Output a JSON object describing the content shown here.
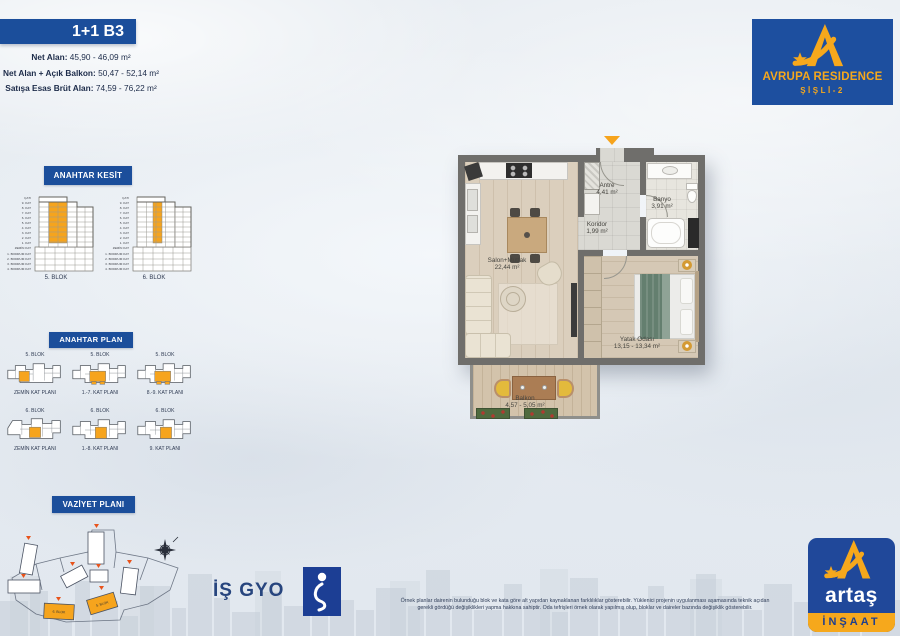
{
  "unit": {
    "title": "1+1 B3",
    "areas": [
      {
        "label": "Net Alan:",
        "value": "45,90 - 46,09 m²"
      },
      {
        "label": "Net Alan + Açık Balkon:",
        "value": "50,47 - 52,14 m²"
      },
      {
        "label": "Satışa Esas Brüt Alan:",
        "value": "74,59 - 76,22 m²"
      }
    ]
  },
  "kesit": {
    "title": "ANAHTAR KESİT",
    "floors": [
      "ÇATI",
      "9. KAT",
      "8. KAT",
      "7. KAT",
      "6. KAT",
      "5. KAT",
      "4. KAT",
      "3. KAT",
      "2. KAT",
      "1. KAT",
      "ZEMİN KAT",
      "1. BODRUM KAT",
      "2. BODRUM KAT",
      "3. BODRUM KAT",
      "4. BODRUM KAT"
    ],
    "blocks": [
      "5. BLOK",
      "6. BLOK"
    ]
  },
  "plan": {
    "title": "ANAHTAR PLAN",
    "items": [
      {
        "block": "5. BLOK",
        "floor": "ZEMİN KAT PLANI"
      },
      {
        "block": "5. BLOK",
        "floor": "1.-7. KAT PLANI"
      },
      {
        "block": "5. BLOK",
        "floor": "8.-9. KAT PLANI"
      },
      {
        "block": "6. BLOK",
        "floor": "ZEMİN KAT PLANI"
      },
      {
        "block": "6. BLOK",
        "floor": "1.-8. KAT PLANI"
      },
      {
        "block": "6. BLOK",
        "floor": "9. KAT PLANI"
      }
    ]
  },
  "vaziyet": {
    "title": "VAZİYET PLANI",
    "labels": [
      "6. BLOK",
      "5. BLOK"
    ]
  },
  "rooms": [
    {
      "name": "Antre",
      "area": "4,41 m²"
    },
    {
      "name": "Banyo",
      "area": "3,91 m²"
    },
    {
      "name": "Koridor",
      "area": "1,99 m²"
    },
    {
      "name": "Salon+Mutfak",
      "area": "22,44 m²"
    },
    {
      "name": "Yatak Odası",
      "area": "13,15 - 13,34 m²"
    },
    {
      "name": "Balkon",
      "area": "4,57 - 5,05 m²"
    }
  ],
  "brand": {
    "avrupa": {
      "name": "AVRUPA RESIDENCE",
      "sub": "ŞİŞLİ-2"
    },
    "isgyo": "İŞ GYO",
    "artas": {
      "name": "artaş",
      "sub": "İNŞAAT"
    }
  },
  "footer": {
    "line1": "Örnek planlar dairenin bulunduğu blok ve kata göre alt yapıdan kaynaklanan farklılıklar gösterebilir. Yüklenici projenin uygulanması aşamasında teknik açıdan",
    "line2": "gerekli gördüğü değişiklikleri yapma hakkına sahiptir. Oda tefrişleri örnek olarak yapılmış olup, bloklar ve daireler bazında değişiklik gösterebilir."
  },
  "colors": {
    "bar_blue": "#1b4e9b",
    "orange": "#f6a41d",
    "navy": "#1c2f52",
    "wall_grey": "#6f6e6b"
  }
}
